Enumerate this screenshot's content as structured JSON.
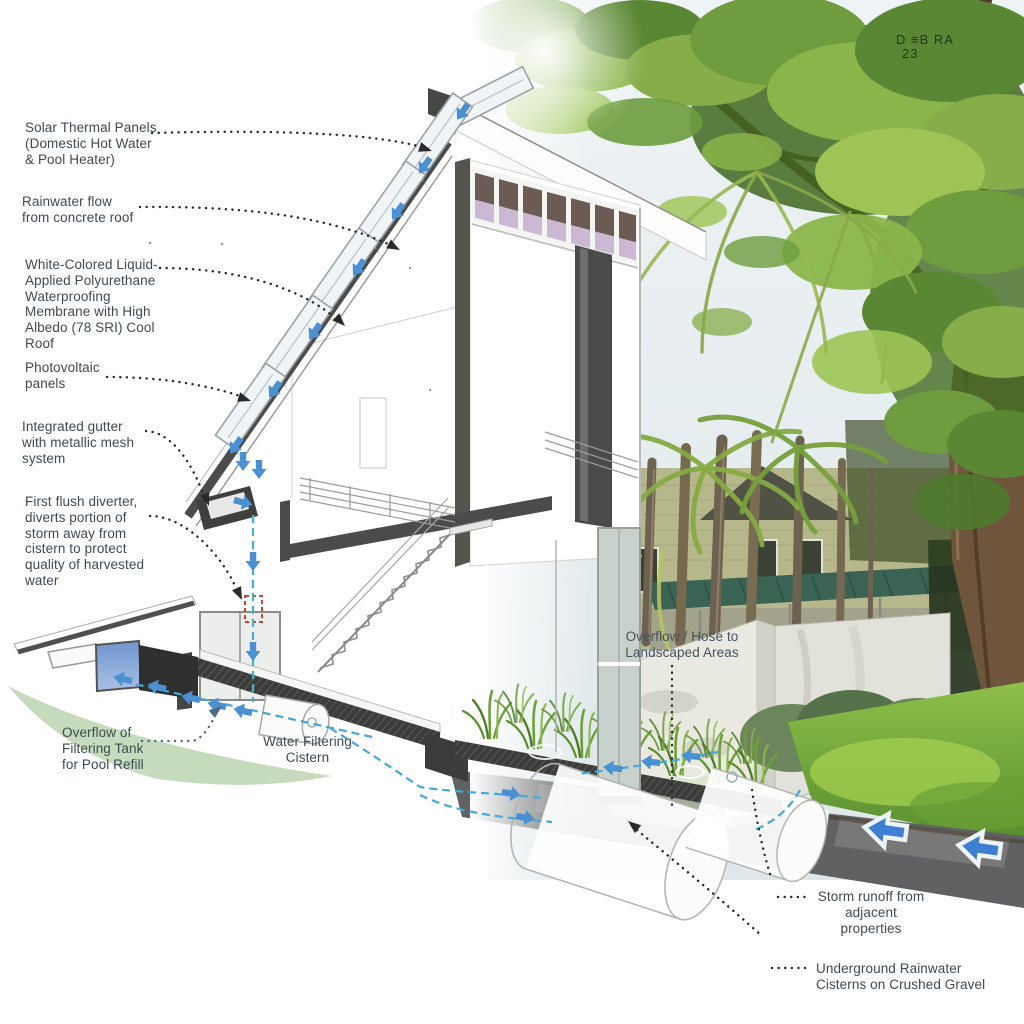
{
  "title": "Sustainable residence rainwater-harvesting section diagram",
  "watermark": {
    "line1": "D ≡B RA",
    "line2": "23"
  },
  "colors": {
    "label_text": "#3d4a54",
    "leader_dots": "#262626",
    "flow_arrow_blue": "#4a90d2",
    "flow_dash_cyan": "#45a8d8",
    "first_flush_red": "#c9453a",
    "section_cut_gray": "#4b4b49",
    "watercolor_green": "#b7d2ab",
    "lawn_green": "#7cb23f",
    "awning_teal": "#3a6354",
    "pavement_gray": "#5f6163",
    "pool_blue": "#7f9fd6"
  },
  "labels": {
    "solar_thermal": {
      "lines": [
        "Solar Thermal Panels",
        "(Domestic Hot Water",
        "& Pool Heater)"
      ]
    },
    "rainwater_flow": {
      "lines": [
        "Rainwater flow",
        "from concrete roof"
      ]
    },
    "membrane": {
      "lines": [
        "White-Colored Liquid-",
        "Applied Polyurethane",
        "Waterproofing",
        "Membrane with High",
        "Albedo (78 SRI) Cool",
        "Roof"
      ]
    },
    "photovoltaic": {
      "lines": [
        "Photovoltaic",
        "panels"
      ]
    },
    "gutter": {
      "lines": [
        "Integrated gutter",
        "with metallic mesh",
        "system"
      ]
    },
    "first_flush": {
      "lines": [
        "First flush diverter,",
        "diverts portion of",
        "storm away from",
        "cistern to protect",
        "quality of harvested",
        "water"
      ]
    },
    "overflow_tank": {
      "lines": [
        "Overflow of",
        "Filtering Tank",
        "for Pool Refill"
      ]
    },
    "water_filtering_cistern": {
      "lines": [
        "Water Filtering",
        "Cistern"
      ]
    },
    "overflow_hose": {
      "lines": [
        "Overflow / Hose to",
        "Landscaped Areas"
      ]
    },
    "storm_runoff": {
      "lines": [
        "Storm runoff from",
        "adjacent",
        "properties"
      ]
    },
    "underground_cisterns": {
      "lines": [
        "Underground Rainwater",
        "Cisterns on Crushed Gravel"
      ]
    }
  }
}
